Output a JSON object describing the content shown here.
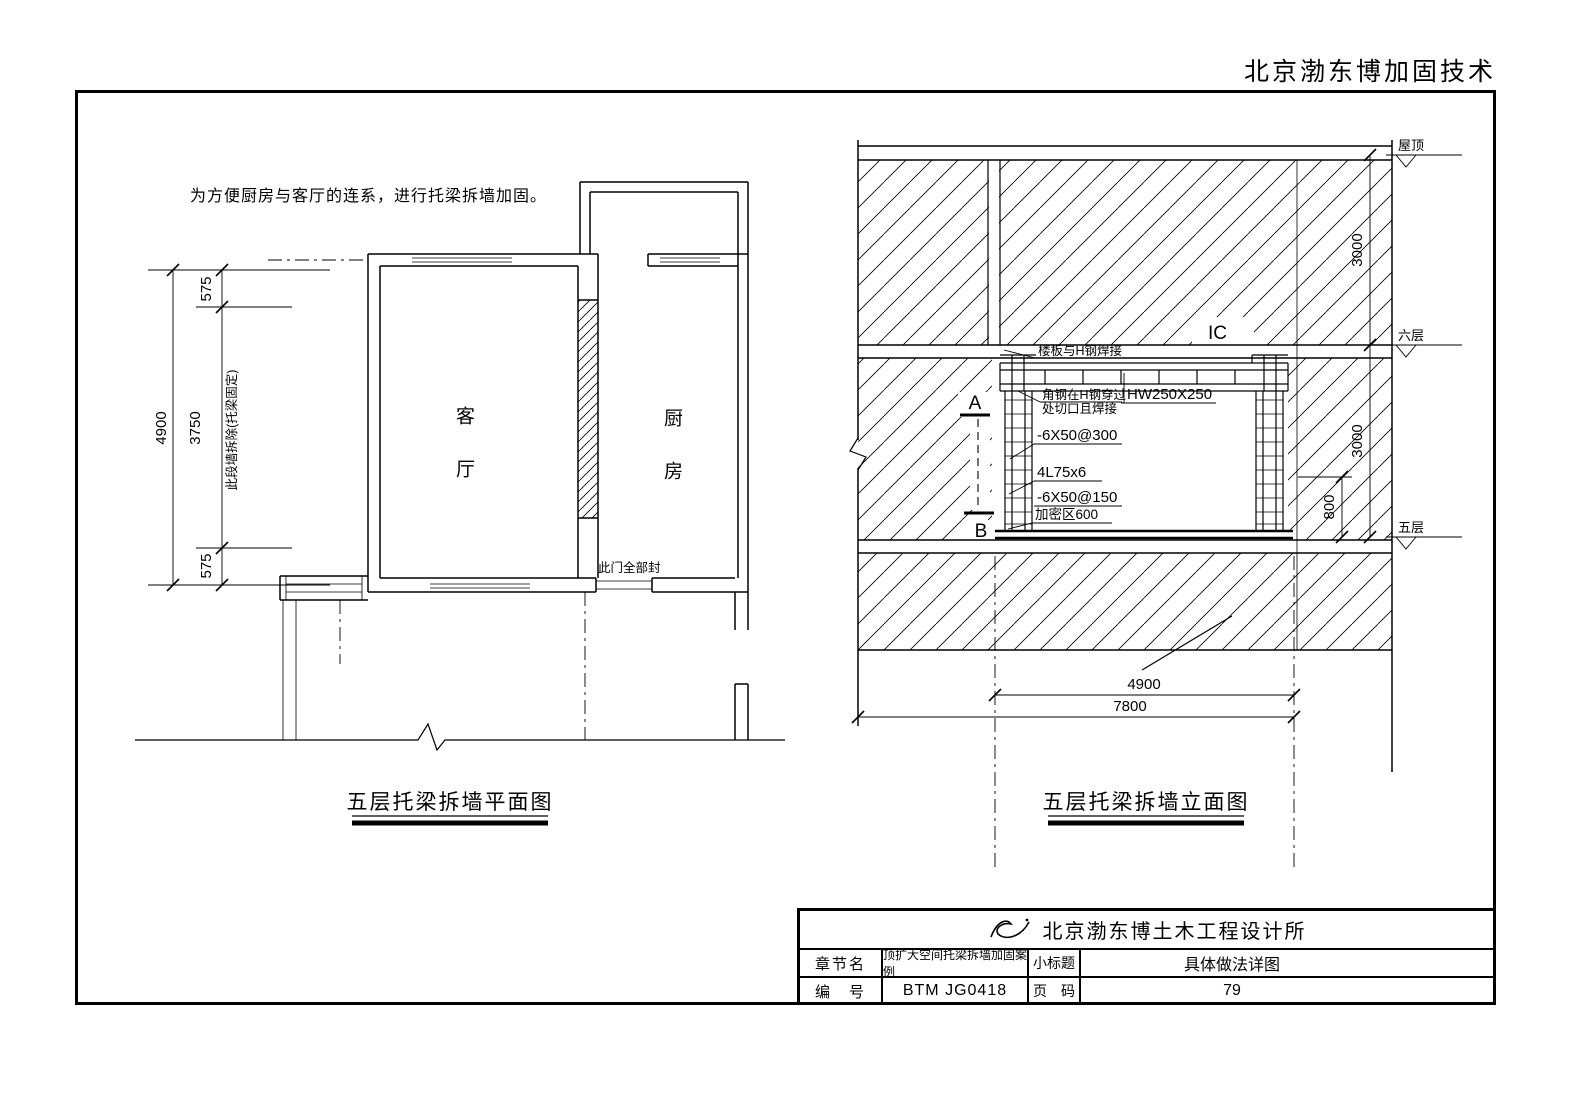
{
  "header": {
    "brand": "北京渤东博加固技术"
  },
  "plan": {
    "note": "为方便厨房与客厅的连系，进行托梁拆墙加固。",
    "room_living": "客厅",
    "room_kitchen": "厨房",
    "door_note": "此门全部封",
    "wall_note": "此段墙拆除(托梁固定)",
    "dim_overall": "4900",
    "dim_top": "575",
    "dim_mid": "3750",
    "dim_bottom": "575",
    "caption": "五层托梁拆墙平面图"
  },
  "elevation": {
    "caption": "五层托梁拆墙立面图",
    "level_roof": "屋顶",
    "level_6f": "六层",
    "level_5f": "五层",
    "dim_storey_upper": "3000",
    "dim_storey_lower": "3000",
    "dim_beam_zone": "800",
    "dim_opening": "4900",
    "dim_overall": "7800",
    "ann_slab_weld": "楼板与H钢焊接",
    "ann_angle_line1": "角钢在H钢穿过",
    "ann_angle_line2": "处切口且焊接",
    "ann_beam": "HW250X250",
    "ann_plate300": "-6X50@300",
    "ann_angle": "4L75x6",
    "ann_plate150": "-6X50@150",
    "ann_dense": "加密区600",
    "mark_a": "A",
    "mark_b": "B",
    "mark_c": "IC"
  },
  "title_block": {
    "company": "北京渤东博土木工程设计所",
    "chapter_label": "章节名",
    "chapter_value": "顶扩大空间托梁拆墙加固案例",
    "subtitle_label": "小标题",
    "subtitle_value": "具体做法详图",
    "number_label": "编　号",
    "number_value": "BTM JG0418",
    "page_label": "页　码",
    "page_value": "79"
  },
  "colors": {
    "line": "#000000",
    "background": "#ffffff"
  }
}
